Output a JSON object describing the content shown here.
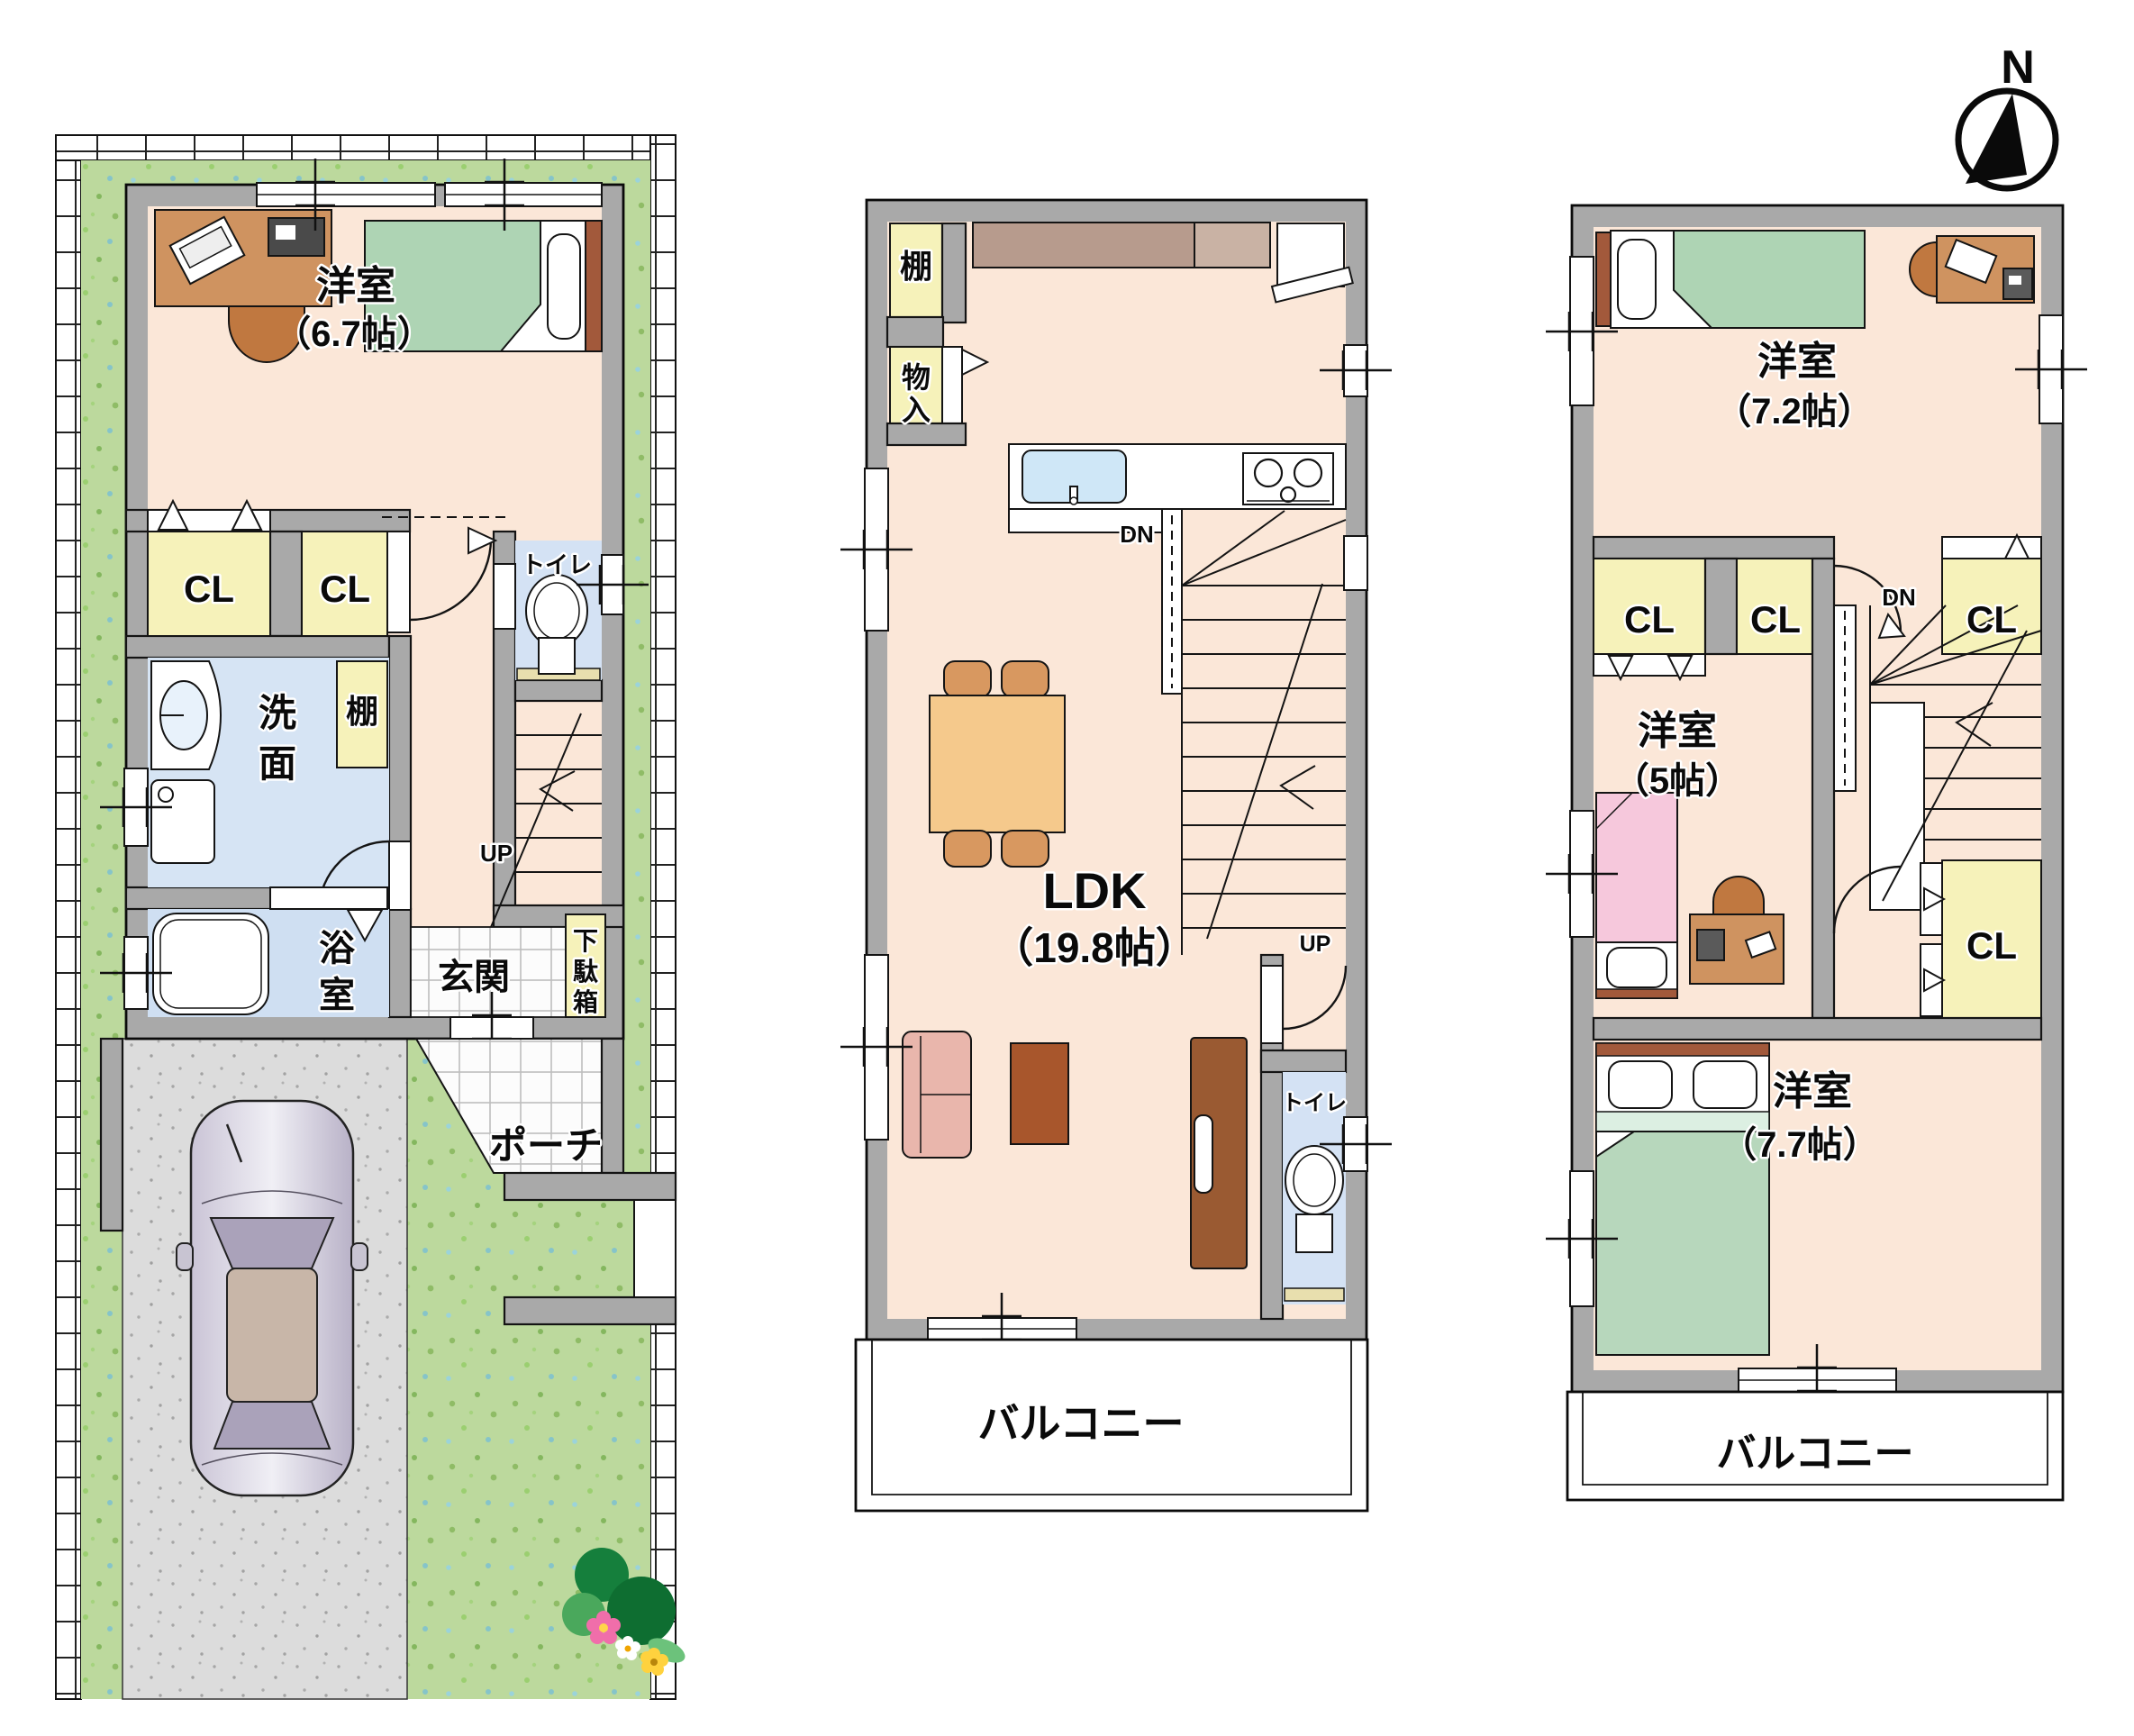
{
  "compass": {
    "label": "N"
  },
  "f1": {
    "room67": {
      "name": "洋室",
      "size": "（6.7帖）"
    },
    "cl1": "CL",
    "cl2": "CL",
    "toilet": "トイレ",
    "wash": [
      "洗",
      "面"
    ],
    "shelf": "棚",
    "bath": [
      "浴",
      "室"
    ],
    "entrance": "玄関",
    "shoebox": [
      "下",
      "駄",
      "箱"
    ],
    "porch": "ポーチ",
    "up": "UP"
  },
  "f2": {
    "shelf": "棚",
    "storage": [
      "物",
      "入"
    ],
    "ldk": {
      "name": "LDK",
      "size": "（19.8帖）"
    },
    "dn": "DN",
    "up": "UP",
    "toilet": "トイレ",
    "balcony": "バルコニー"
  },
  "f3": {
    "room72": {
      "name": "洋室",
      "size": "（7.2帖）"
    },
    "cl1": "CL",
    "cl2": "CL",
    "cl3": "CL",
    "dn": "DN",
    "room5": {
      "name": "洋室",
      "size": "（5帖）"
    },
    "cl4": "CL",
    "room77": {
      "name": "洋室",
      "size": "（7.7帖）"
    },
    "balcony": "バルコニー"
  }
}
